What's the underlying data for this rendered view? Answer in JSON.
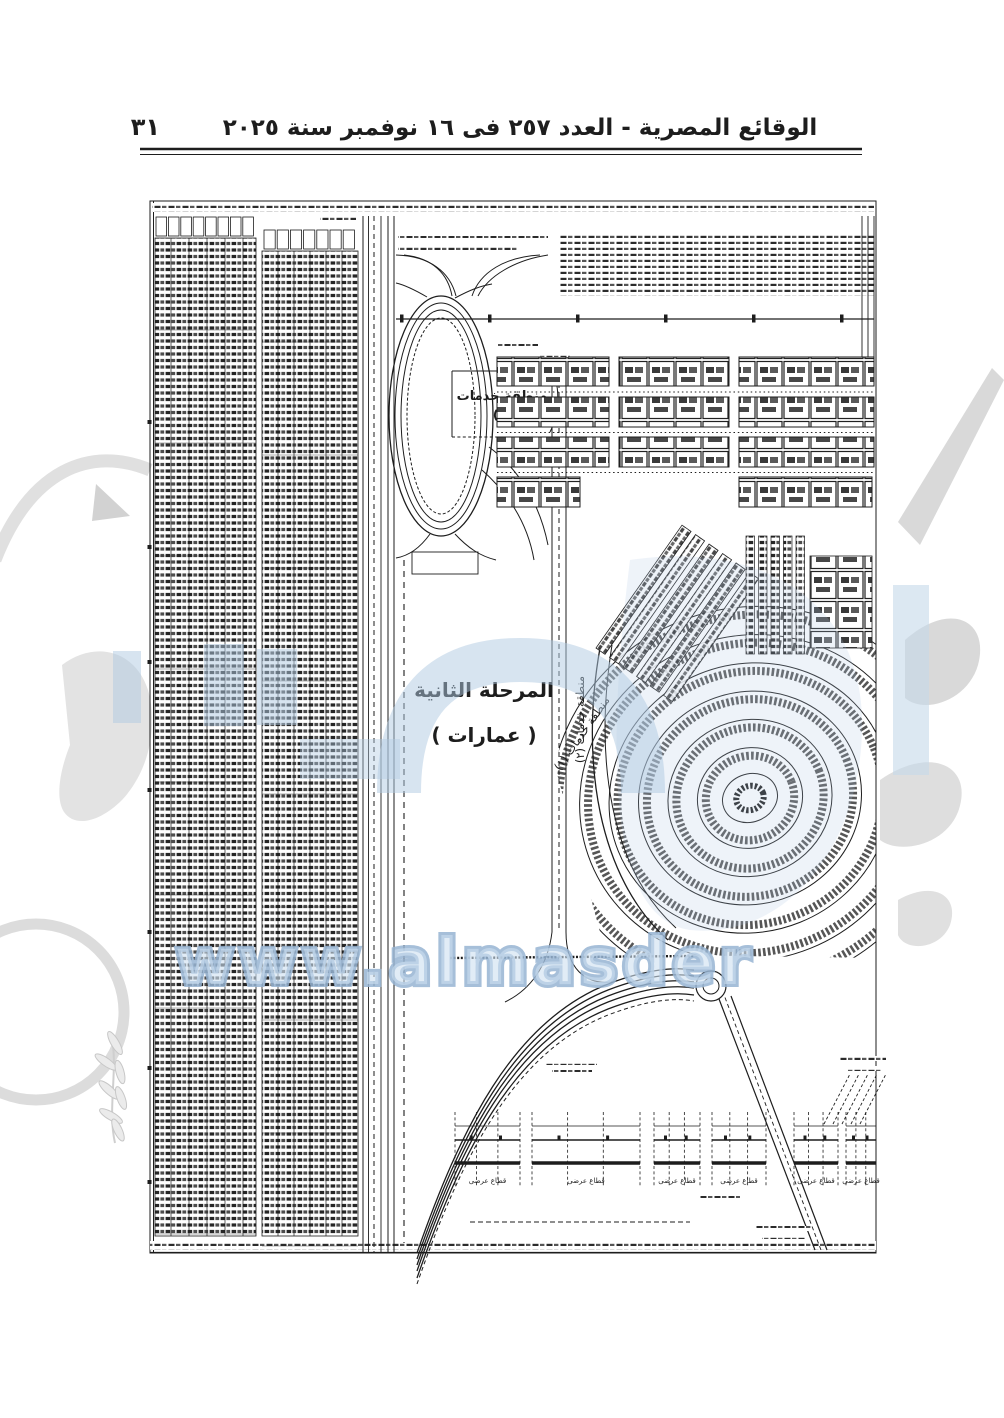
{
  "document": {
    "header": {
      "page_number": "٣١",
      "title": "الوقائع المصرية - العدد ٢٥٧ فى ١٦ نوفمبر سنة ٢٠٢٥"
    },
    "map": {
      "labels": {
        "phase_title": "المرحلة الثانية",
        "phase_subtitle": "( عمارات )",
        "services_zone_2": "منطقة خدمات",
        "services_zone_2_number": "(٢)",
        "services_zone_2_rotated": "منطقة خدمات (٢)",
        "services_zone_1_rotated": "منطقة خدمات (١)",
        "cross_section_label": "قطاع عرضى"
      }
    },
    "watermark": {
      "site_text": "www.almasder",
      "blue_color": "#b9cfe4",
      "gray_color": "#d8d8d8"
    },
    "colors": {
      "ink": "#1d1d1d",
      "paper": "#ffffff"
    }
  }
}
